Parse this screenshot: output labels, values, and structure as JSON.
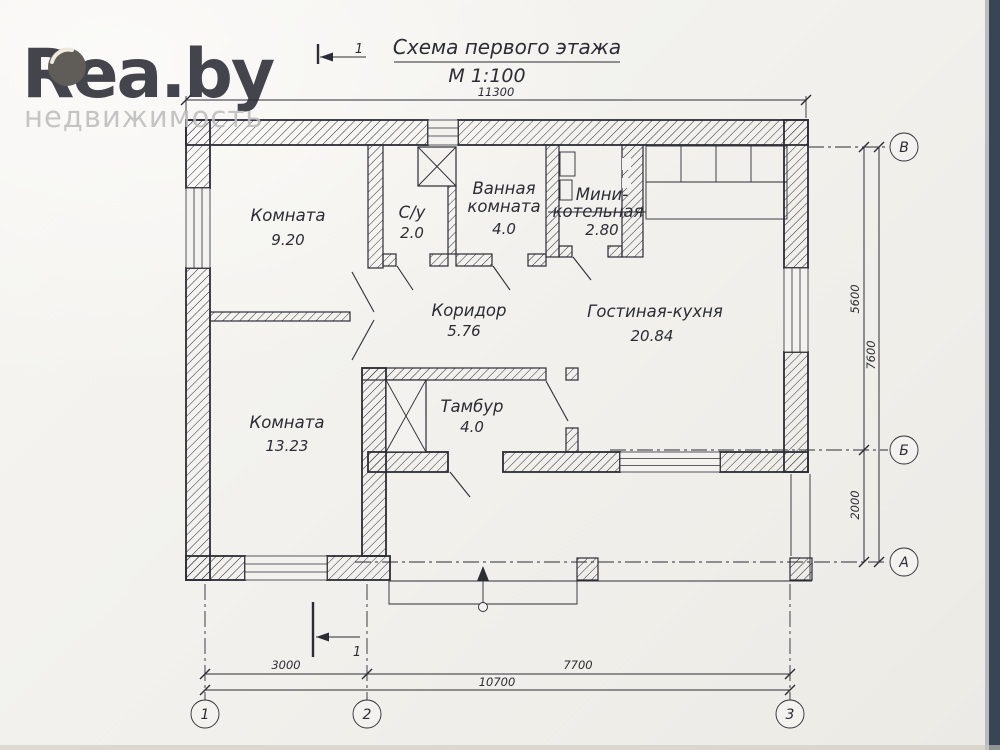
{
  "logo": {
    "brand": "Rea.by",
    "subtitle": "недвижимость",
    "brand_color": "#d3ac74",
    "subtitle_color": "#bebdbf"
  },
  "title": {
    "main": "Схема первого этажа",
    "scale": "М 1:100"
  },
  "section": {
    "top_label": "1",
    "bottom_label": "1"
  },
  "rooms": {
    "room1": {
      "name": "Комната",
      "area": "9.20"
    },
    "su": {
      "name": "С/у",
      "area": "2.0"
    },
    "bath": {
      "line1": "Ванная",
      "line2": "комната",
      "area": "4.0"
    },
    "boiler": {
      "line1": "Мини-",
      "line2": "котельная",
      "area": "2.80"
    },
    "corridor": {
      "name": "Коридор",
      "area": "5.76"
    },
    "living": {
      "name": "Гостиная-кухня",
      "area": "20.84"
    },
    "room2": {
      "name": "Комната",
      "area": "13.23"
    },
    "tambour": {
      "name": "Тамбур",
      "area": "4.0"
    }
  },
  "dimensions": {
    "top_total": "11300",
    "right_upper": "5600",
    "right_lower": "2000",
    "right_total": "7600",
    "bottom_left": "3000",
    "bottom_right": "7700",
    "bottom_total": "10700"
  },
  "axes": {
    "row_top": "В",
    "row_mid": "Б",
    "row_bottom": "А",
    "col_left": "1",
    "col_mid": "2",
    "col_right": "3"
  },
  "colors": {
    "ink": "#2c2c35",
    "paper": "#f2f1ed",
    "scan_edge": "#384553"
  }
}
